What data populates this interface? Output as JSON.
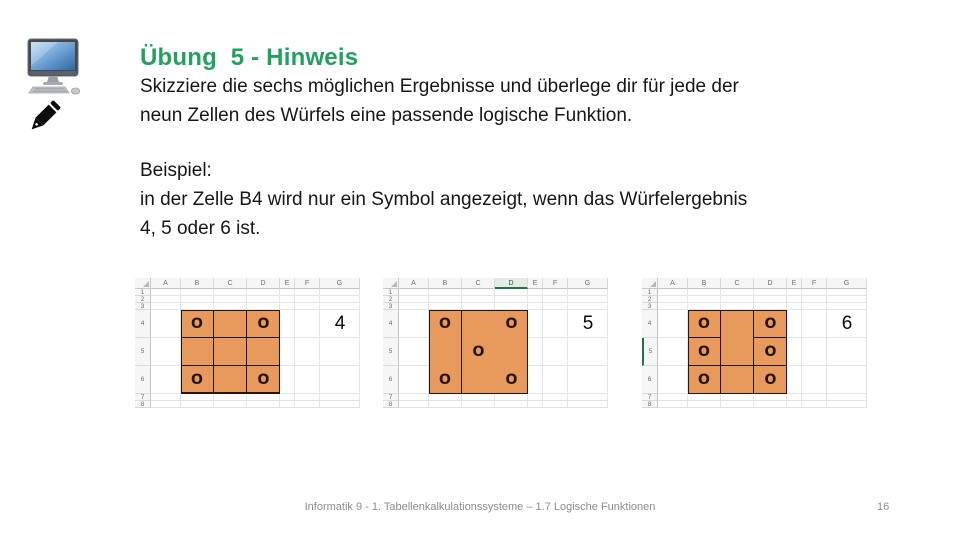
{
  "colors": {
    "title_green": "#23A05F",
    "dice_orange": "#E8995C",
    "dice_border": "#241409",
    "select_green": "#217346",
    "footer_gray": "#8C8C8C",
    "screen_blue": "#3A71AD"
  },
  "header": {
    "title": "Übung  5 - Hinweis"
  },
  "intro": {
    "lines": [
      "Skizziere die sechs möglichen Ergebnisse und überlege dir für jede der",
      "neun Zellen des Würfels eine passende logische Funktion."
    ]
  },
  "example": {
    "lines": [
      "Beispiel:",
      "in der Zelle B4 wird nur ein Symbol angezeigt, wenn das Würfelergebnis",
      "4, 5 oder 6 ist."
    ]
  },
  "symbols": {
    "dice_symbol": "O"
  },
  "spreadsheets": [
    {
      "result": "4",
      "result_cell": "G4",
      "columns": [
        "A",
        "B",
        "C",
        "D",
        "E",
        "F",
        "G"
      ],
      "rows": [
        "1",
        "2",
        "3",
        "4",
        "5",
        "6",
        "7",
        "8"
      ],
      "dice_range": "B4:D6",
      "symbol_cells": [
        "B4",
        "D4",
        "B6",
        "D6"
      ],
      "selected_column": "",
      "selected_row": ""
    },
    {
      "result": "5",
      "result_cell": "G4",
      "columns": [
        "A",
        "B",
        "C",
        "D",
        "E",
        "F",
        "G"
      ],
      "rows": [
        "1",
        "2",
        "3",
        "4",
        "5",
        "6",
        "7",
        "8"
      ],
      "dice_range": "B4:D6",
      "symbol_cells": [
        "B4",
        "D4",
        "C5",
        "B6",
        "D6"
      ],
      "selected_column": "D",
      "selected_row": ""
    },
    {
      "result": "6",
      "result_cell": "G4",
      "columns": [
        "A",
        "B",
        "C",
        "D",
        "E",
        "F",
        "G"
      ],
      "rows": [
        "1",
        "2",
        "3",
        "4",
        "5",
        "6",
        "7",
        "8"
      ],
      "dice_range": "B4:D6",
      "symbol_cells": [
        "B4",
        "D4",
        "B5",
        "D5",
        "B6",
        "D6"
      ],
      "selected_column": "",
      "selected_row": "5"
    }
  ],
  "footer": {
    "text": "Informatik 9 - 1. Tabellenkalkulationssysteme – 1.7 Logische Funktionen",
    "page": "16"
  }
}
